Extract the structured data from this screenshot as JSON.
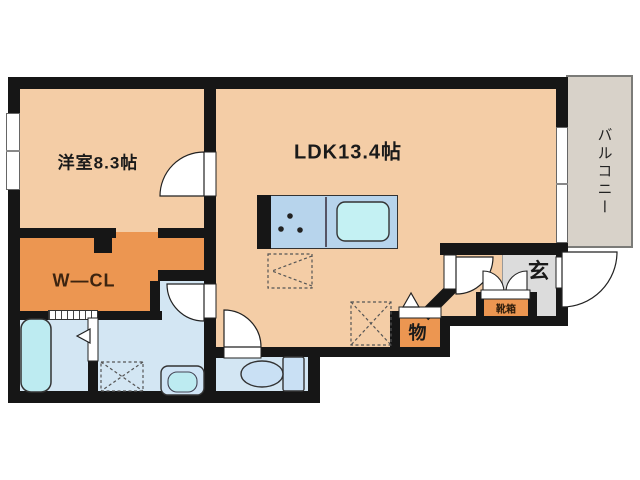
{
  "plan": {
    "type": "apartment-floor-plan",
    "labels": {
      "western_room": "洋室8.3帖",
      "ldk": "LDK13.4帖",
      "walk_in_closet": "W—CL",
      "balcony": "バルコニー",
      "entrance": "玄",
      "shoe_box": "靴箱",
      "storage": "物"
    },
    "colors": {
      "room_floor": "#F4CDA6",
      "closet_floor": "#EC9651",
      "wet_area_floor": "#D3E6F3",
      "kitchen_counter": "#B7D4EC",
      "fixture_fill": "#BDEBF1",
      "balcony_floor": "#D8D2C9",
      "entrance_floor": "#DCDCDC",
      "wall": "#161616",
      "background": "#FFFFFF"
    }
  }
}
